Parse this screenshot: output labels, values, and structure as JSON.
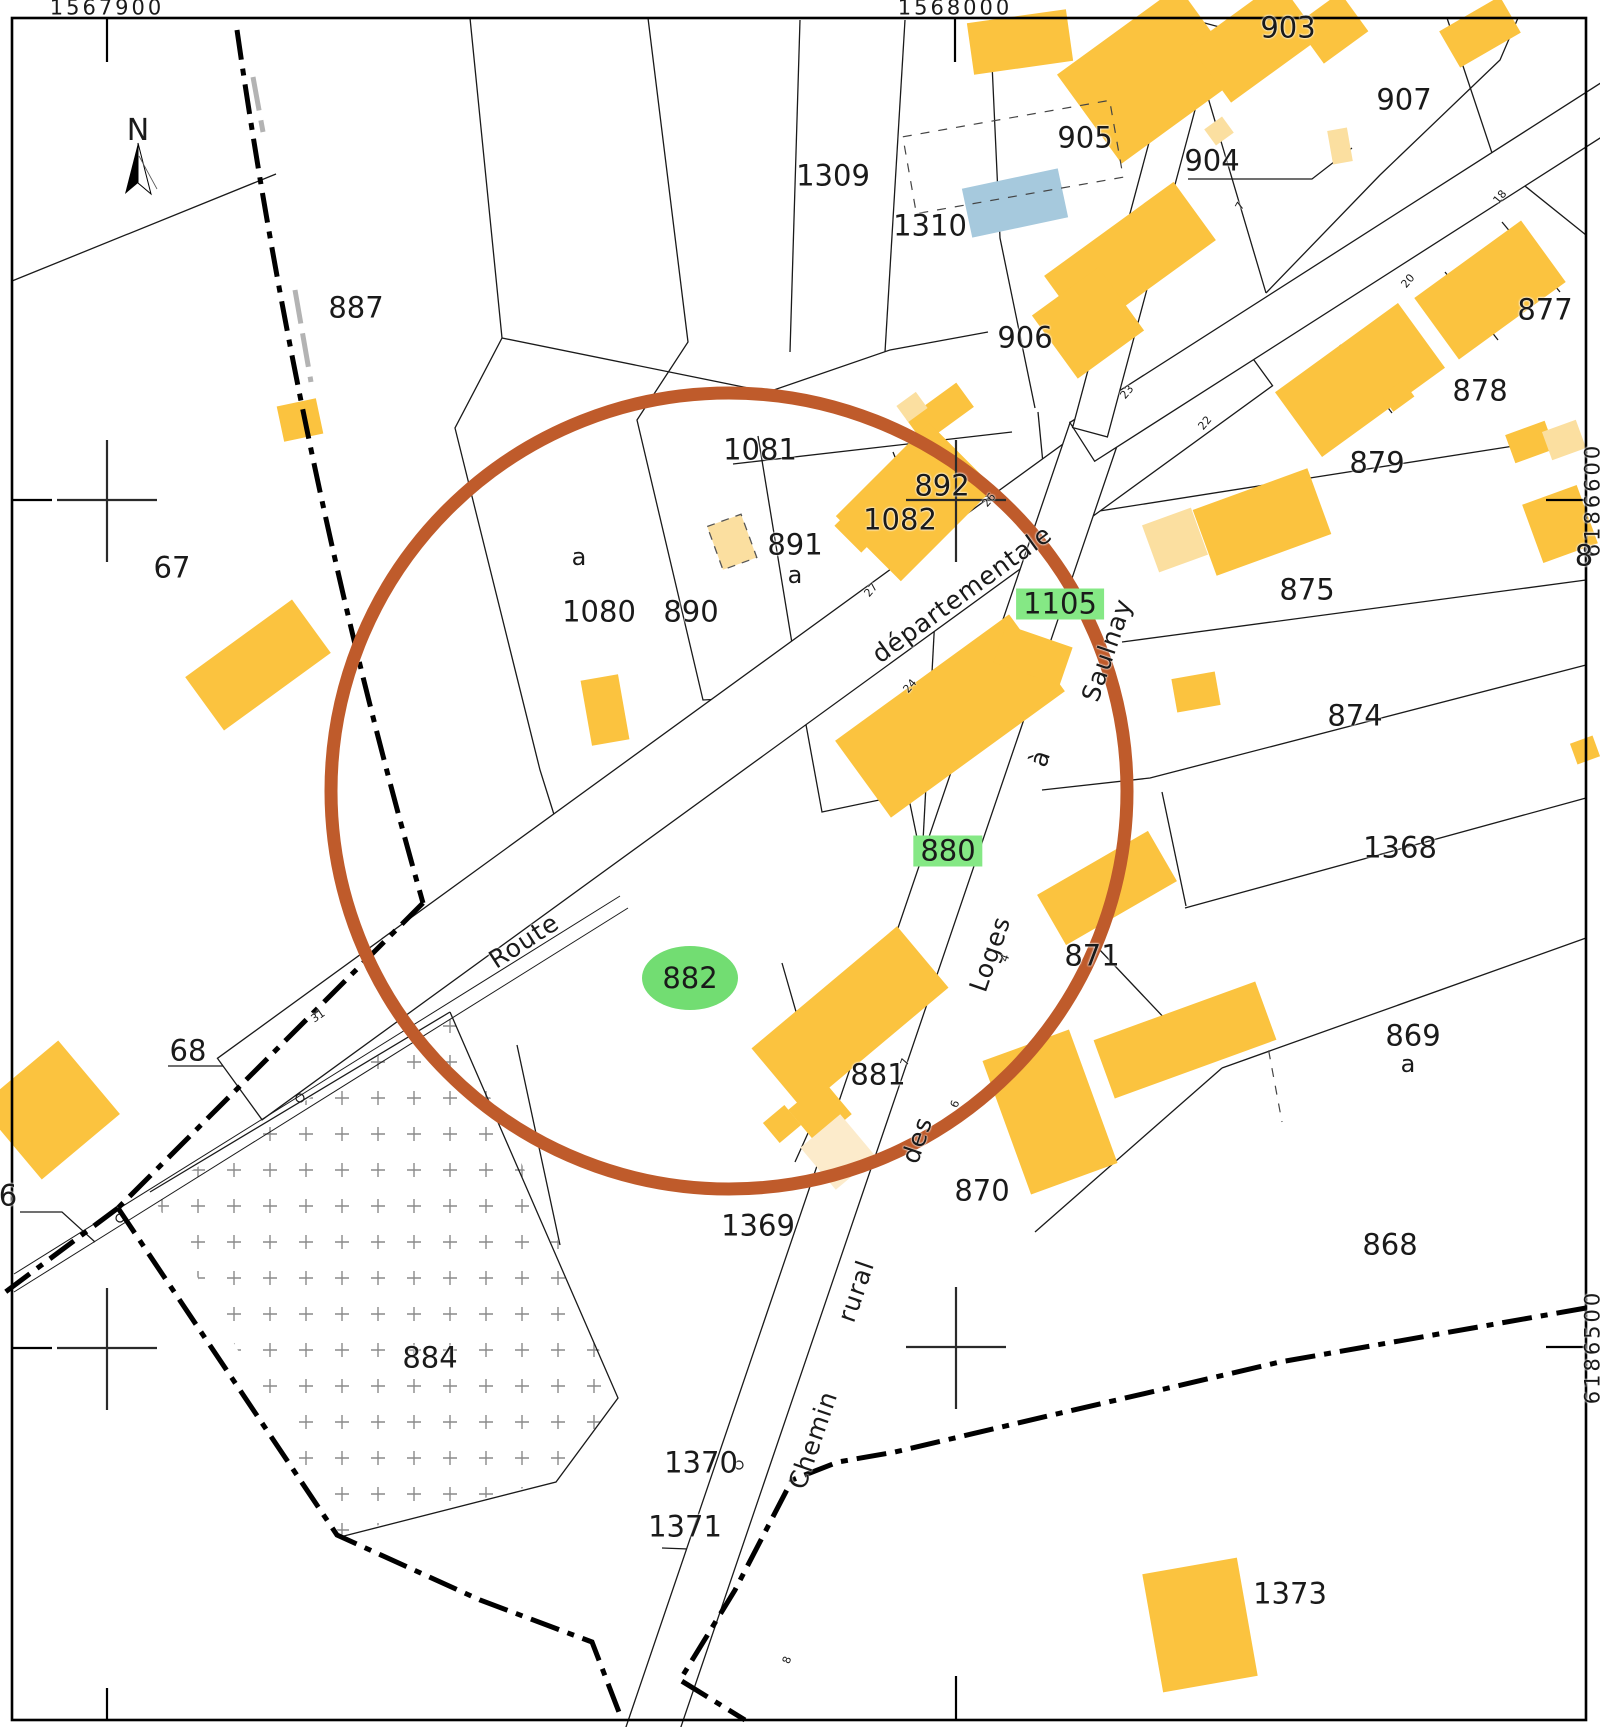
{
  "map": {
    "type": "cadastral-plan",
    "north_label": "N",
    "road_full_names": [
      "Route départementale",
      "Chemin rural des Loges à Saulnay"
    ],
    "colors": {
      "building_yellow": "#FBC33F",
      "building_pale": "#FBDFA0",
      "building_pale_light": "#FCEBCB",
      "building_blue": "#A6C9DD",
      "highlight_green": "#85E885",
      "ellipse_green": "#72DD72",
      "circle_orange": "#BF5B2B",
      "line": "#1a1a1a"
    },
    "label_groups": {
      "coords": {
        "class": "coord",
        "prefix": "grid-coordinate"
      },
      "parcels": {
        "class": "parcel",
        "prefix": "parcel-label"
      },
      "subletters": {
        "class": "sub",
        "prefix": "parcel-sub-label"
      },
      "green_boxes": {
        "class": "green-box",
        "prefix": "highlighted-parcel-label"
      },
      "green_ellipses": {
        "class": "green-ellipse",
        "prefix": "selected-parcel-label"
      },
      "road_words": {
        "class": "road-name",
        "prefix": "road-name-word"
      },
      "house_numbers": {
        "class": "house-num",
        "prefix": "house-number"
      }
    },
    "coords": [
      {
        "text": "1567900",
        "x": 107,
        "y": 8
      },
      {
        "text": "1568000",
        "x": 955,
        "y": 8
      },
      {
        "text": "6186600",
        "x": 1593,
        "y": 500,
        "rot": -90
      },
      {
        "text": "6186500",
        "x": 1593,
        "y": 1347,
        "rot": -90
      },
      {
        "text": "6186600",
        "x": -8,
        "y": 500,
        "rot": -90
      },
      {
        "text": "6186500",
        "x": -8,
        "y": 1347,
        "rot": -90
      }
    ],
    "parcels": [
      {
        "text": "887",
        "x": 356,
        "y": 308
      },
      {
        "text": "67",
        "x": 172,
        "y": 568
      },
      {
        "text": "68",
        "x": 188,
        "y": 1051
      },
      {
        "text": "6",
        "x": 8,
        "y": 1196
      },
      {
        "text": "884",
        "x": 430,
        "y": 1358
      },
      {
        "text": "1309",
        "x": 833,
        "y": 176
      },
      {
        "text": "1310",
        "x": 930,
        "y": 226
      },
      {
        "text": "905",
        "x": 1085,
        "y": 138
      },
      {
        "text": "904",
        "x": 1212,
        "y": 161
      },
      {
        "text": "903",
        "x": 1288,
        "y": 28
      },
      {
        "text": "907",
        "x": 1404,
        "y": 100
      },
      {
        "text": "906",
        "x": 1025,
        "y": 338
      },
      {
        "text": "877",
        "x": 1545,
        "y": 310
      },
      {
        "text": "878",
        "x": 1480,
        "y": 391
      },
      {
        "text": "879",
        "x": 1377,
        "y": 463
      },
      {
        "text": "875",
        "x": 1307,
        "y": 590
      },
      {
        "text": "874",
        "x": 1355,
        "y": 716
      },
      {
        "text": "1368",
        "x": 1400,
        "y": 848
      },
      {
        "text": "871",
        "x": 1092,
        "y": 956
      },
      {
        "text": "881",
        "x": 878,
        "y": 1075
      },
      {
        "text": "870",
        "x": 982,
        "y": 1191
      },
      {
        "text": "869",
        "x": 1413,
        "y": 1036
      },
      {
        "text": "868",
        "x": 1390,
        "y": 1245
      },
      {
        "text": "1081",
        "x": 760,
        "y": 450
      },
      {
        "text": "892",
        "x": 942,
        "y": 486
      },
      {
        "text": "1082",
        "x": 900,
        "y": 520
      },
      {
        "text": "891",
        "x": 795,
        "y": 545
      },
      {
        "text": "1080",
        "x": 599,
        "y": 612
      },
      {
        "text": "890",
        "x": 691,
        "y": 612
      },
      {
        "text": "1369",
        "x": 758,
        "y": 1226
      },
      {
        "text": "1370",
        "x": 701,
        "y": 1463
      },
      {
        "text": "1371",
        "x": 685,
        "y": 1527
      },
      {
        "text": "1373",
        "x": 1290,
        "y": 1594
      },
      {
        "text": "8",
        "x": 1584,
        "y": 556
      }
    ],
    "subletters": [
      {
        "text": "a",
        "x": 579,
        "y": 557
      },
      {
        "text": "a",
        "x": 795,
        "y": 575
      },
      {
        "text": "a",
        "x": 1408,
        "y": 1064
      }
    ],
    "green_boxes": [
      {
        "text": "1105",
        "x": 1060,
        "y": 604
      },
      {
        "text": "880",
        "x": 948,
        "y": 851
      }
    ],
    "green_ellipses": [
      {
        "text": "882",
        "x": 690,
        "y": 978
      }
    ],
    "road_words": [
      {
        "text": "Route",
        "x": 524,
        "y": 941,
        "rot": -33
      },
      {
        "text": "départementale",
        "x": 962,
        "y": 594,
        "rot": -36
      },
      {
        "text": "Chemin",
        "x": 813,
        "y": 1440,
        "rot": -71
      },
      {
        "text": "rural",
        "x": 856,
        "y": 1291,
        "rot": -71
      },
      {
        "text": "des",
        "x": 917,
        "y": 1140,
        "rot": -71
      },
      {
        "text": "Loges",
        "x": 990,
        "y": 954,
        "rot": -71
      },
      {
        "text": "à",
        "x": 1040,
        "y": 758,
        "rot": -71
      },
      {
        "text": "Saulnay",
        "x": 1107,
        "y": 650,
        "rot": -71
      }
    ],
    "house_numbers": [
      {
        "text": "7",
        "x": 1240,
        "y": 206,
        "rot": -60
      },
      {
        "text": "18",
        "x": 1500,
        "y": 197,
        "rot": -50
      },
      {
        "text": "20",
        "x": 1408,
        "y": 281,
        "rot": -50
      },
      {
        "text": "22",
        "x": 1205,
        "y": 423,
        "rot": -50
      },
      {
        "text": "23",
        "x": 1127,
        "y": 392,
        "rot": -50
      },
      {
        "text": "26",
        "x": 989,
        "y": 500,
        "rot": -50
      },
      {
        "text": "27",
        "x": 871,
        "y": 590,
        "rot": -50
      },
      {
        "text": "24",
        "x": 910,
        "y": 686,
        "rot": -50
      },
      {
        "text": "31",
        "x": 318,
        "y": 1016,
        "rot": -35
      },
      {
        "text": "4",
        "x": 1005,
        "y": 958,
        "rot": -70
      },
      {
        "text": "6",
        "x": 955,
        "y": 1104,
        "rot": -70
      },
      {
        "text": "7",
        "x": 905,
        "y": 1062,
        "rot": -70
      },
      {
        "text": "8",
        "x": 787,
        "y": 1660,
        "rot": -70
      }
    ]
  }
}
